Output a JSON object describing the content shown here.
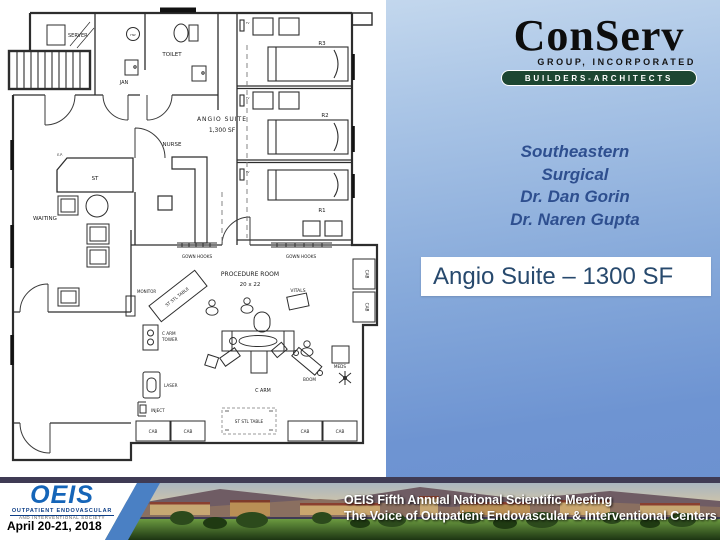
{
  "logo": {
    "name": "ConServ",
    "group_line": "GROUP, INCORPORATED",
    "builders_line": "BUILDERS-ARCHITECTS"
  },
  "client": {
    "lines": [
      "Southeastern",
      "Surgical",
      "Dr. Dan Gorin",
      "Dr. Naren Gupta"
    ]
  },
  "callout": {
    "text": "Angio Suite – 1300 SF"
  },
  "floor_plan": {
    "labels": {
      "server": "SERVER",
      "jan": "JAN",
      "toilet": "TOILET",
      "hw": "HW",
      "angio_suite": "ANGIO SUITE",
      "angio_sf": "1,300 SF",
      "nurse": "NURSE",
      "st": "ST",
      "ep": "E.P.",
      "waiting": "WAITING",
      "r3": "R3",
      "r2": "R2",
      "r1": "R1",
      "gown_hooks": "GOWN HOOKS",
      "procedure_room": "PROCEDURE ROOM",
      "procedure_size": "20 x 22",
      "monitor": "MONITOR",
      "st_stl_table": "ST STL TABLE",
      "vitals": "VITALS",
      "c_arm": "C ARM",
      "tower": "TOWER",
      "laser": "LASER",
      "inject": "INJECT",
      "boom": "BOOM",
      "meds": "MEDS",
      "cab": "CAB",
      "tv": "TV"
    }
  },
  "footer": {
    "oeis_logo": {
      "acronym": "OEIS",
      "line1": "OUTPATIENT ENDOVASCULAR",
      "line2": "AND INTERVENTIONAL SOCIETY"
    },
    "date": "April 20-21, 2018",
    "banner_line1": "OEIS Fifth Annual National Scientific Meeting",
    "banner_line2": "The Voice of Outpatient Endovascular & Interventional Centers"
  },
  "colors": {
    "slide_blue": "#6e94d2",
    "pill_green": "#1d4632",
    "client_text": "#2e4f8f",
    "callout_text": "#27496d",
    "banner_strip": "#3f3b54",
    "oeis_blue": "#1565b8",
    "footer_stripe_blue": "#4a80c4"
  }
}
